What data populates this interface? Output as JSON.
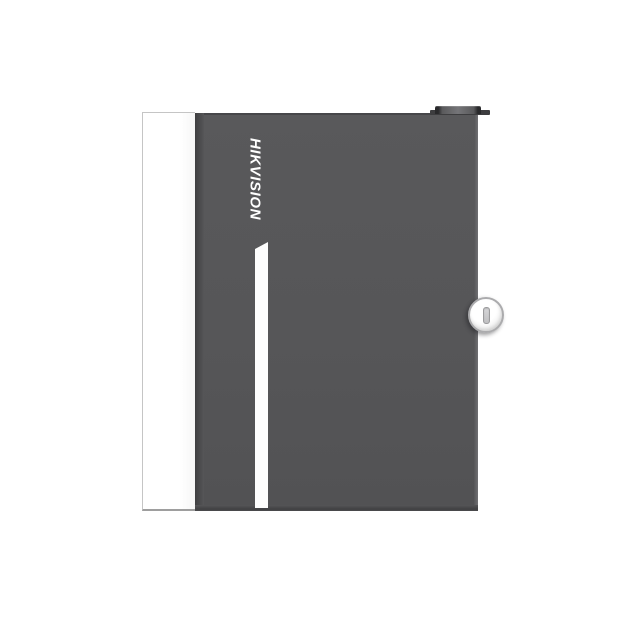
{
  "image": {
    "description": "Product photo of a dark gray wall-mount metal enclosure cabinet with a white side panel, vertical HIKVISION brand logo, white accent stripe, round key lock on the door and a small cable gland on top",
    "background_color": "#ffffff"
  },
  "device": {
    "brand_label": "HIKVISION",
    "colors": {
      "background": "#ffffff",
      "door": "#565658",
      "door_edge_dark": "#47474a",
      "door_edge_highlight": "#707073",
      "side_panel": "#ffffff",
      "panel_border": "#c5c5c5",
      "accent_stripe": "#fdfdfd",
      "logo_text": "#ffffff",
      "lock_face": "#ffffff",
      "lock_ring": "#ababad",
      "keyhole": "#c0c0c2",
      "top_knob_base": "#3d3d3f",
      "top_knob_highlight": "#757578"
    }
  }
}
